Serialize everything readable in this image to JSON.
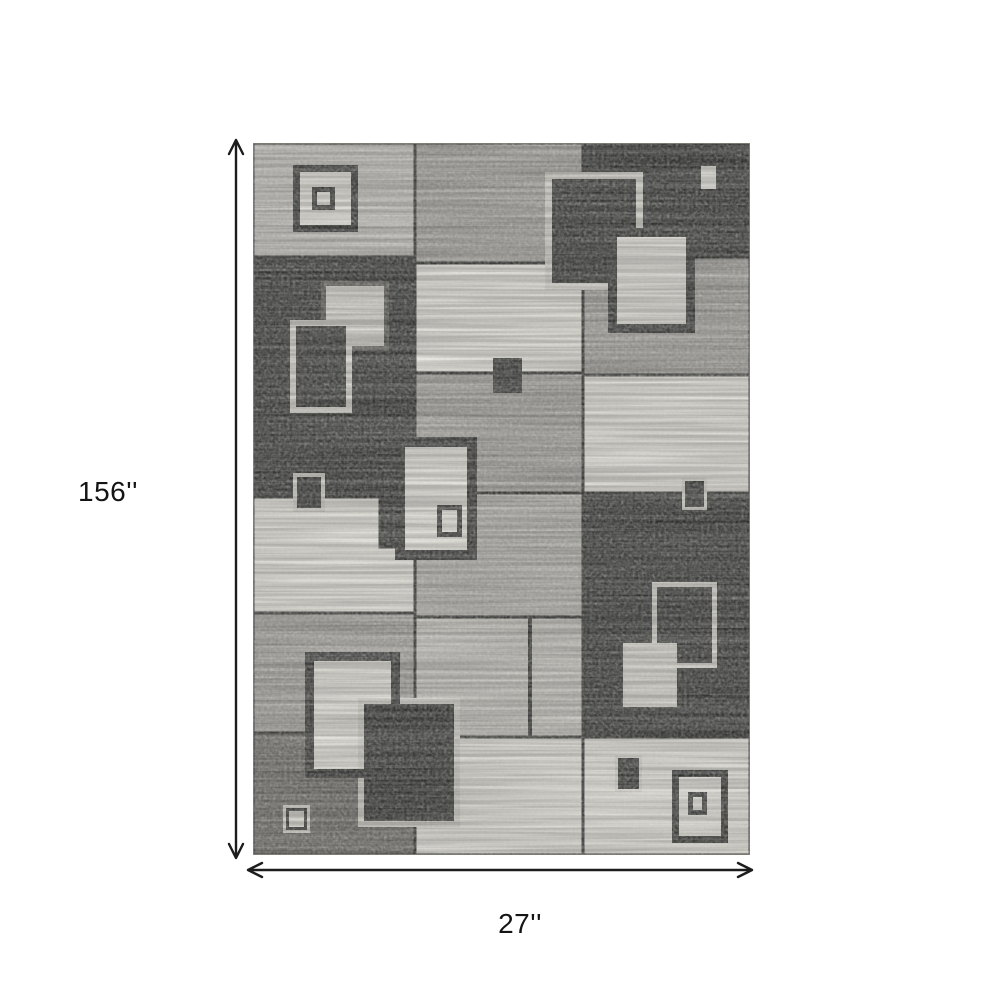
{
  "page": {
    "background": "#ffffff"
  },
  "dimensions": {
    "height_label": "156''",
    "width_label": "27''"
  },
  "arrows": {
    "color": "#1c1c1c",
    "stroke_width": 2.4,
    "head_len": 14,
    "head_half_w": 7,
    "vertical": {
      "x": 236,
      "tip1_y": 140,
      "tip2_y": 858
    },
    "horizontal": {
      "y": 870,
      "tip1_x": 248,
      "tip2_x": 752
    }
  },
  "rug": {
    "x": 253,
    "y": 143,
    "width": 497,
    "height": 712,
    "grout_color": "#343432",
    "edge_color": "#8a8880",
    "palette": {
      "light": "#c7c5c0",
      "medium": "#a8a6a1",
      "mlight": "#b6b4ae",
      "greige": "#c8c6bf",
      "cream": "#e9e7df",
      "clight": "#dddbd3",
      "dark": "#393937",
      "middark": "#716f6b",
      "bcream": "#d9d7cf",
      "dgray": "#5a5954"
    },
    "patches": [
      {
        "x": 0,
        "y": 0,
        "w": 162,
        "h": 114,
        "c": "light"
      },
      {
        "x": 162,
        "y": 0,
        "w": 168,
        "h": 120,
        "c": "medium"
      },
      {
        "x": 330,
        "y": 0,
        "w": 167,
        "h": 114,
        "c": "dark"
      },
      {
        "x": 0,
        "y": 114,
        "w": 162,
        "h": 240,
        "c": "dark"
      },
      {
        "x": 330,
        "y": 114,
        "w": 167,
        "h": 118,
        "c": "medium"
      },
      {
        "x": 162,
        "y": 120,
        "w": 168,
        "h": 110,
        "c": "cream"
      },
      {
        "x": 330,
        "y": 232,
        "w": 167,
        "h": 118,
        "c": "cream"
      },
      {
        "x": 162,
        "y": 230,
        "w": 168,
        "h": 120,
        "c": "medium"
      },
      {
        "x": 0,
        "y": 354,
        "w": 162,
        "h": 116,
        "c": "cream"
      },
      {
        "x": 127,
        "y": 354,
        "w": 35,
        "h": 50,
        "c": "dark"
      },
      {
        "x": 162,
        "y": 350,
        "w": 168,
        "h": 124,
        "c": "mlight"
      },
      {
        "x": 330,
        "y": 350,
        "w": 167,
        "h": 244,
        "c": "dark"
      },
      {
        "x": 0,
        "y": 470,
        "w": 162,
        "h": 120,
        "c": "medium"
      },
      {
        "x": 162,
        "y": 474,
        "w": 168,
        "h": 120,
        "c": "greige"
      },
      {
        "x": 0,
        "y": 590,
        "w": 162,
        "h": 122,
        "c": "middark"
      },
      {
        "x": 162,
        "y": 594,
        "w": 168,
        "h": 118,
        "c": "cream"
      },
      {
        "x": 330,
        "y": 594,
        "w": 167,
        "h": 118,
        "c": "cream"
      }
    ],
    "grout_lines": [
      {
        "x": 275,
        "y": 474,
        "w": 4,
        "h": 120
      }
    ],
    "ornaments": [
      {
        "x": 40,
        "y": 22,
        "w": 65,
        "h": 67,
        "c": "dark"
      },
      {
        "x": 47,
        "y": 29,
        "w": 51,
        "h": 53,
        "c": "cream"
      },
      {
        "x": 59,
        "y": 44,
        "w": 23,
        "h": 23,
        "c": "dark"
      },
      {
        "x": 64,
        "y": 49,
        "w": 13,
        "h": 13,
        "c": "cream"
      },
      {
        "x": 444,
        "y": 19,
        "w": 23,
        "h": 31,
        "c": "dark"
      },
      {
        "x": 448,
        "y": 23,
        "w": 15,
        "h": 23,
        "c": "cream"
      },
      {
        "x": 292,
        "y": 29,
        "w": 98,
        "h": 118,
        "c": "bcream"
      },
      {
        "x": 299,
        "y": 36,
        "w": 84,
        "h": 104,
        "c": "dark"
      },
      {
        "x": 355,
        "y": 85,
        "w": 87,
        "h": 105,
        "c": "dark"
      },
      {
        "x": 364,
        "y": 94,
        "w": 69,
        "h": 87,
        "c": "cream"
      },
      {
        "x": 68,
        "y": 138,
        "w": 68,
        "h": 70,
        "c": "dgray"
      },
      {
        "x": 73,
        "y": 143,
        "w": 58,
        "h": 60,
        "c": "clight"
      },
      {
        "x": 37,
        "y": 177,
        "w": 62,
        "h": 93,
        "c": "bcream"
      },
      {
        "x": 43,
        "y": 183,
        "w": 50,
        "h": 81,
        "c": "dark"
      },
      {
        "x": 40,
        "y": 330,
        "w": 32,
        "h": 39,
        "c": "bcream"
      },
      {
        "x": 44,
        "y": 334,
        "w": 24,
        "h": 31,
        "c": "dark"
      },
      {
        "x": 240,
        "y": 215,
        "w": 29,
        "h": 35,
        "c": "dark"
      },
      {
        "x": 142,
        "y": 294,
        "w": 82,
        "h": 123,
        "c": "dark"
      },
      {
        "x": 152,
        "y": 304,
        "w": 62,
        "h": 103,
        "c": "cream"
      },
      {
        "x": 184,
        "y": 362,
        "w": 25,
        "h": 32,
        "c": "dark"
      },
      {
        "x": 189,
        "y": 367,
        "w": 15,
        "h": 22,
        "c": "cream"
      },
      {
        "x": 429,
        "y": 335,
        "w": 25,
        "h": 32,
        "c": "bcream"
      },
      {
        "x": 432,
        "y": 338,
        "w": 19,
        "h": 26,
        "c": "dark"
      },
      {
        "x": 399,
        "y": 439,
        "w": 65,
        "h": 86,
        "c": "bcream"
      },
      {
        "x": 404,
        "y": 444,
        "w": 55,
        "h": 76,
        "c": "dark"
      },
      {
        "x": 370,
        "y": 500,
        "w": 54,
        "h": 64,
        "c": "bcream"
      },
      {
        "x": 372,
        "y": 502,
        "w": 50,
        "h": 60,
        "c": "clight"
      },
      {
        "x": 52,
        "y": 509,
        "w": 95,
        "h": 126,
        "c": "dark"
      },
      {
        "x": 61,
        "y": 518,
        "w": 77,
        "h": 108,
        "c": "cream"
      },
      {
        "x": 105,
        "y": 555,
        "w": 102,
        "h": 129,
        "c": "bcream"
      },
      {
        "x": 111,
        "y": 561,
        "w": 90,
        "h": 117,
        "c": "dark"
      },
      {
        "x": 138,
        "y": 509,
        "w": 9,
        "h": 126,
        "c": "dark"
      },
      {
        "x": 52,
        "y": 626,
        "w": 95,
        "h": 9,
        "c": "dark"
      },
      {
        "x": 30,
        "y": 662,
        "w": 27,
        "h": 28,
        "c": "bcream"
      },
      {
        "x": 33,
        "y": 665,
        "w": 21,
        "h": 22,
        "c": "dark"
      },
      {
        "x": 36,
        "y": 668,
        "w": 15,
        "h": 16,
        "c": "clight"
      },
      {
        "x": 362,
        "y": 612,
        "w": 27,
        "h": 37,
        "c": "bcream"
      },
      {
        "x": 365,
        "y": 615,
        "w": 21,
        "h": 31,
        "c": "dark"
      },
      {
        "x": 419,
        "y": 627,
        "w": 56,
        "h": 73,
        "c": "dark"
      },
      {
        "x": 426,
        "y": 634,
        "w": 42,
        "h": 59,
        "c": "cream"
      },
      {
        "x": 435,
        "y": 649,
        "w": 19,
        "h": 23,
        "c": "dark"
      },
      {
        "x": 440,
        "y": 654,
        "w": 9,
        "h": 13,
        "c": "cream"
      }
    ]
  }
}
